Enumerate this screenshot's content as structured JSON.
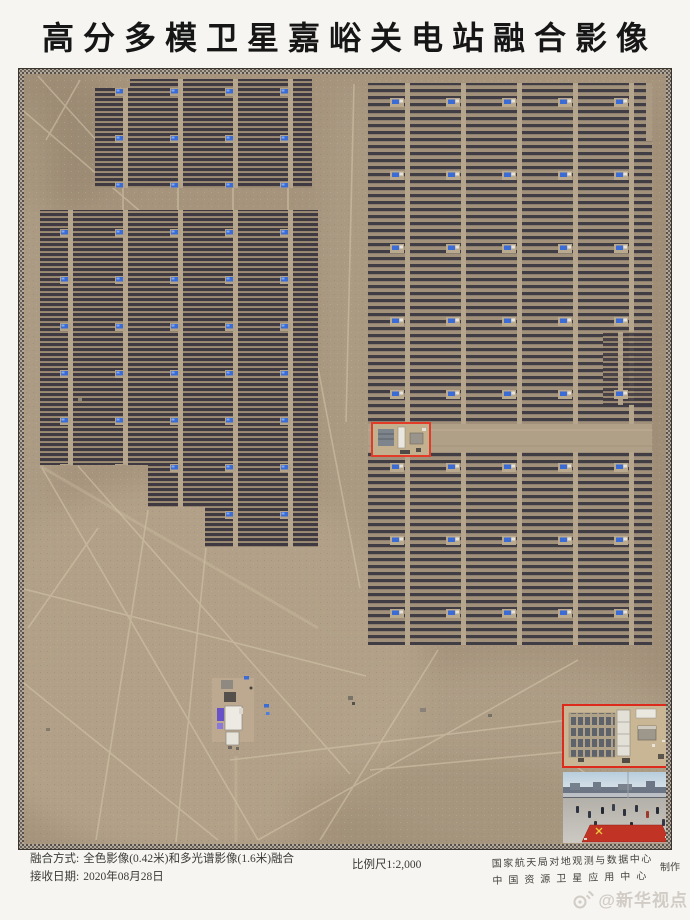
{
  "title": "高分多模卫星嘉峪关电站融合影像",
  "map": {
    "colors": {
      "desert": "#a6947d",
      "panel_dark": "#3f3a42",
      "road_tan": "#b6a68d",
      "inverter_blue": "#3b6cd6",
      "highlight_red": "#e23b28",
      "inset_border_red": "#dc2a1c",
      "carpet_red": "#c03325"
    }
  },
  "footer": {
    "fusion_label": "融合方式:",
    "fusion_value": "全色影像(0.42米)和多光谱影像(1.6米)融合",
    "date_label": "接收日期:",
    "date_value": "2020年08月28日",
    "scale": "比例尺1:2,000",
    "credit_line1": "国家航天局对地观测与数据中心",
    "credit_line2": "中国资源卫星应用中心",
    "credit_suffix": "制作"
  },
  "watermark": {
    "icon": "weibo-icon",
    "text": "@新华视点"
  }
}
